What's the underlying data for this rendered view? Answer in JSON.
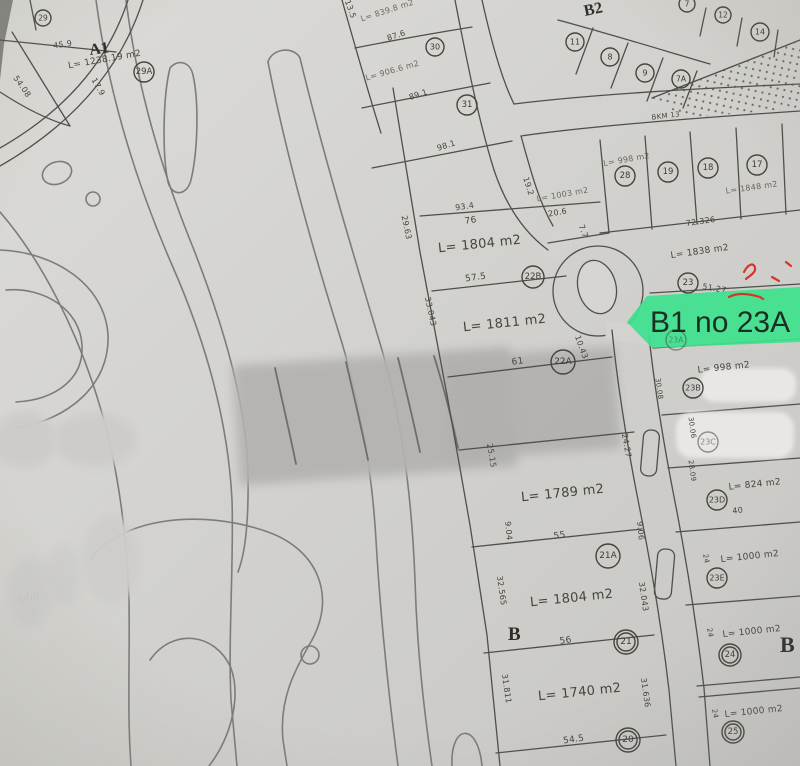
{
  "document": {
    "type": "scanned cadastral plan photo",
    "highlight": {
      "label": "B1 no 23A",
      "color": "#3ee18e"
    },
    "colors": {
      "paper": "#d3d2ce",
      "plot_line": "#504f4b",
      "contour_line": "#7d7c79",
      "redaction_grey": "#b3b2b0",
      "white_blob": "#e8e7e5",
      "red_mark": "#d93425",
      "highlight_green": "#3ee18e"
    }
  },
  "zones": [
    {
      "t": "A1"
    },
    {
      "t": "B2"
    },
    {
      "t": "B"
    },
    {
      "t": "B"
    }
  ],
  "circles": [
    {
      "n": "29"
    },
    {
      "n": "29A"
    },
    {
      "n": "30"
    },
    {
      "n": "31"
    },
    {
      "n": "11"
    },
    {
      "n": "8"
    },
    {
      "n": "9"
    },
    {
      "n": "7A"
    },
    {
      "n": "7"
    },
    {
      "n": "12"
    },
    {
      "n": "14"
    },
    {
      "n": "28"
    },
    {
      "n": "19"
    },
    {
      "n": "18"
    },
    {
      "n": "17"
    },
    {
      "n": "22B"
    },
    {
      "n": "22A"
    },
    {
      "n": "21A"
    },
    {
      "n": "21"
    },
    {
      "n": "20"
    },
    {
      "n": "23"
    },
    {
      "n": "23A"
    },
    {
      "n": "23B"
    },
    {
      "n": "23C"
    },
    {
      "n": "23D"
    },
    {
      "n": "23E"
    },
    {
      "n": "24"
    },
    {
      "n": "25"
    }
  ],
  "texts": [
    {
      "t": "L= 1238.19 m2"
    },
    {
      "t": "45.9"
    },
    {
      "t": "54.08"
    },
    {
      "t": "17.9"
    },
    {
      "t": "87.6"
    },
    {
      "t": "89.1"
    },
    {
      "t": "98.1"
    },
    {
      "t": "L= 839.8 m2"
    },
    {
      "t": "L= 906.6 m2"
    },
    {
      "t": "93.4"
    },
    {
      "t": "76"
    },
    {
      "t": "L= 1804 m2"
    },
    {
      "t": "57.5"
    },
    {
      "t": "L= 1811 m2"
    },
    {
      "t": "61"
    },
    {
      "t": "L= 1789 m2"
    },
    {
      "t": "55"
    },
    {
      "t": "L= 1804 m2"
    },
    {
      "t": "56"
    },
    {
      "t": "L= 1740 m2"
    },
    {
      "t": "54.5"
    },
    {
      "t": "29.63"
    },
    {
      "t": "33.043"
    },
    {
      "t": "25.15"
    },
    {
      "t": "24.27"
    },
    {
      "t": "9.04"
    },
    {
      "t": "9.06"
    },
    {
      "t": "32.565"
    },
    {
      "t": "32.043"
    },
    {
      "t": "31.811"
    },
    {
      "t": "31.636"
    },
    {
      "t": "10.43"
    },
    {
      "t": "19.2"
    },
    {
      "t": "L= 1003 m2"
    },
    {
      "t": "20.6"
    },
    {
      "t": "7.7"
    },
    {
      "t": "L= 998 m2"
    },
    {
      "t": "L= 1848 m2"
    },
    {
      "t": "72.326"
    },
    {
      "t": "BKM 13"
    },
    {
      "t": "L= 1838 m2"
    },
    {
      "t": "51.27"
    },
    {
      "t": "L= 998 m2"
    },
    {
      "t": "L= 824 m2"
    },
    {
      "t": "40"
    },
    {
      "t": "L= 1000 m2"
    },
    {
      "t": "L= 1000 m2"
    },
    {
      "t": "L= 1000 m2"
    },
    {
      "t": "24"
    },
    {
      "t": "24"
    },
    {
      "t": "24"
    },
    {
      "t": "30.06"
    },
    {
      "t": "28.09"
    },
    {
      "t": "30.08"
    },
    {
      "t": "13.5"
    },
    {
      "t": "olin"
    }
  ]
}
